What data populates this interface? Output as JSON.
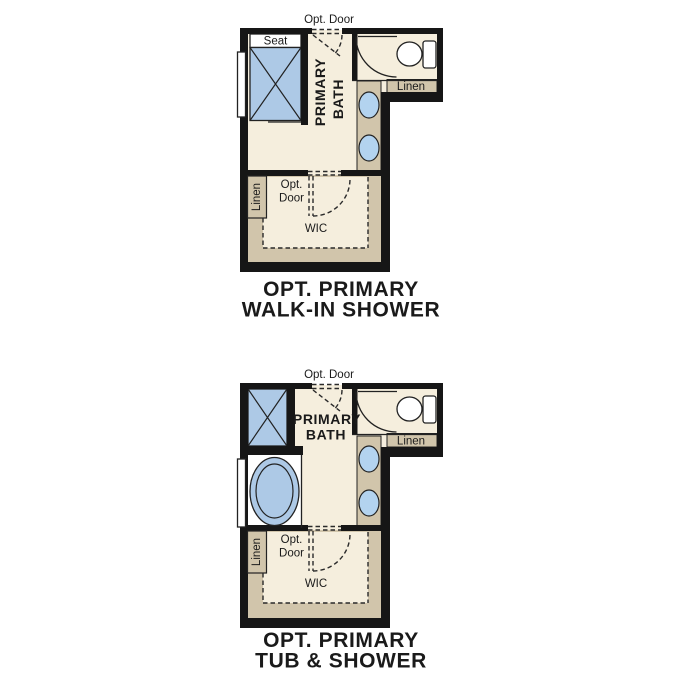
{
  "colors": {
    "background": "#ffffff",
    "wall": "#161616",
    "floor": "#f5eedd",
    "cabinetry_tan": "#d1c5ab",
    "fixture_blue": "#adc9e6",
    "fixture_white": "#ffffff",
    "outline": "#222222",
    "text": "#1a1a1a"
  },
  "plans": [
    {
      "caption_line1": "OPT. PRIMARY",
      "caption_line2": "WALK-IN SHOWER",
      "labels": {
        "opt_door_top": "Opt. Door",
        "seat": "Seat",
        "room_line1": "PRIMARY",
        "room_line2": "BATH",
        "linen_upper": "Linen",
        "linen_lower": "Linen",
        "wic_door_line1": "Opt.",
        "wic_door_line2": "Door",
        "wic": "WIC"
      }
    },
    {
      "caption_line1": "OPT. PRIMARY",
      "caption_line2": "TUB & SHOWER",
      "labels": {
        "opt_door_top": "Opt. Door",
        "room_line1": "PRIMARY",
        "room_line2": "BATH",
        "linen_upper": "Linen",
        "linen_lower": "Linen",
        "wic_door_line1": "Opt.",
        "wic_door_line2": "Door",
        "wic": "WIC"
      }
    }
  ]
}
